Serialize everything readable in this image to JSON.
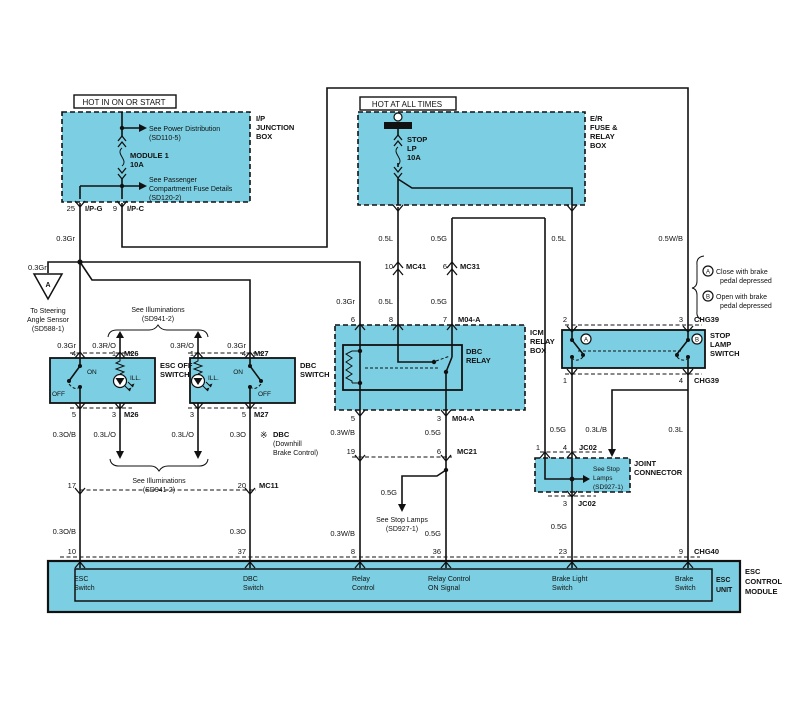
{
  "colors": {
    "box_fill": "#7CCFE2",
    "line": "#111111",
    "background": "#FFFFFF"
  },
  "headers": {
    "hot_on_start": "HOT IN ON OR START",
    "hot_all_times": "HOT AT ALL TIMES"
  },
  "ip_box": {
    "name1": "I/P",
    "name2": "JUNCTION",
    "name3": "BOX",
    "see_power1": "See Power Distribution",
    "see_power2": "(SD110-5)",
    "fuse1": "MODULE 1",
    "fuse2": "10A",
    "see_pass1": "See Passenger",
    "see_pass2": "Compartment Fuse Details",
    "see_pass3": "(SD120-2)",
    "pin25": "25",
    "ipg": "I/P-G",
    "pin9": "9",
    "ipc": "I/P-C"
  },
  "er_box": {
    "name1": "E/R",
    "name2": "FUSE &",
    "name3": "RELAY",
    "name4": "BOX",
    "fuse1": "STOP",
    "fuse2": "LP",
    "fuse3": "10A"
  },
  "wires": {
    "gr": "0.3Gr",
    "ro": "0.3R/O",
    "l05": "0.5L",
    "g05": "0.5G",
    "wb05": "0.5W/B",
    "ob": "0.3O/B",
    "lo": "0.3L/O",
    "o": "0.3O",
    "wb03": "0.3W/B",
    "lb": "0.3L/B",
    "l03": "0.3L"
  },
  "steering": {
    "tri": "A",
    "t1": "To Steering",
    "t2": "Angle Sensor",
    "t3": "(SD588-1)"
  },
  "illum": {
    "t1": "See Illuminations",
    "t2": "(SD941-2)"
  },
  "esc_switch": {
    "name1": "ESC OFF",
    "name2": "SWITCH",
    "on": "ON",
    "off": "OFF",
    "ill": "ILL.",
    "pin4": "4",
    "pin1": "1",
    "pin5": "5",
    "pin3": "3",
    "conn": "M26"
  },
  "dbc_switch": {
    "name1": "DBC",
    "name2": "SWITCH",
    "on": "ON",
    "off": "OFF",
    "ill": "ILL.",
    "pin1": "1",
    "pin4": "4",
    "pin3": "3",
    "pin5": "5",
    "conn": "M27"
  },
  "dbc_note": {
    "mark": "※",
    "t1": "DBC",
    "t2": "(Downhill",
    "t3": "Brake Control)"
  },
  "connectors": {
    "mc41": "MC41",
    "mc41_pin": "10",
    "mc31": "MC31",
    "mc31_pin": "6",
    "mc21": "MC21",
    "mc21_pin19": "19",
    "mc21_pin6": "6",
    "mc11": "MC11",
    "mc11_pin17": "17",
    "mc11_pin20": "20"
  },
  "icm_box": {
    "name1": "ICM",
    "name2": "RELAY",
    "name3": "BOX",
    "relay1": "DBC",
    "relay2": "RELAY",
    "pin6": "6",
    "pin8": "8",
    "pin7": "7",
    "pin5": "5",
    "pin3": "3",
    "conn": "M04-A"
  },
  "stop_lamp_switch": {
    "name1": "STOP",
    "name2": "LAMP",
    "name3": "SWITCH",
    "pin2": "2",
    "pin3": "3",
    "pin1": "1",
    "pin4": "4",
    "conn": "CHG39",
    "a": "A",
    "b": "B"
  },
  "brake_note": {
    "a": "A",
    "a1": "Close with brake",
    "a2": "pedal depressed",
    "b": "B",
    "b1": "Open with brake",
    "b2": "pedal depressed"
  },
  "joint_conn": {
    "name1": "JOINT",
    "name2": "CONNECTOR",
    "pin1": "1",
    "pin4": "4",
    "pin3": "3",
    "conn": "JC02",
    "t1": "See Stop",
    "t2": "Lamps",
    "t3": "(SD927-1)"
  },
  "stop_lamps_ref": {
    "t1": "See Stop Lamps",
    "t2": "(SD927-1)"
  },
  "module": {
    "pin10": "10",
    "pin37": "37",
    "pin8": "8",
    "pin36": "36",
    "pin23": "23",
    "pin9": "9",
    "conn": "CHG40",
    "sig1a": "ESC",
    "sig1b": "Switch",
    "sig2a": "DBC",
    "sig2b": "Switch",
    "sig3a": "Relay",
    "sig3b": "Control",
    "sig4a": "Relay Control",
    "sig4b": "ON Signal",
    "sig5a": "Brake Light",
    "sig5b": "Switch",
    "sig6a": "Brake",
    "sig6b": "Switch",
    "unit1": "ESC",
    "unit2": "UNIT",
    "name1": "ESC",
    "name2": "CONTROL",
    "name3": "MODULE"
  }
}
